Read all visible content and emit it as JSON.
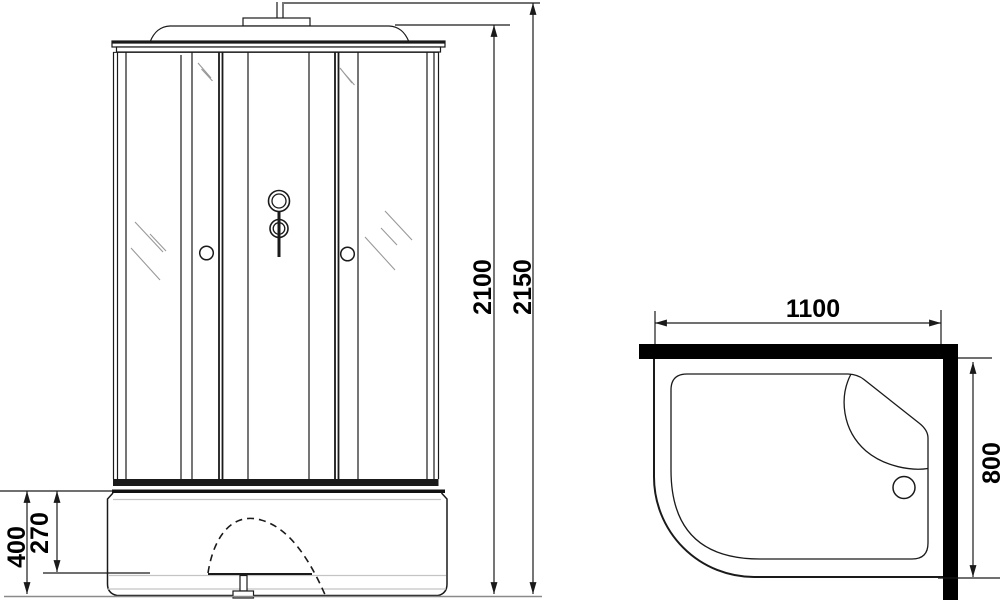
{
  "drawing": {
    "type": "shower-cabin-technical-drawing",
    "dimensions": {
      "front": {
        "overall_height": "2150",
        "cabin_height": "2100",
        "tray_height": "400",
        "tray_step_height": "270"
      },
      "top": {
        "width": "1100",
        "depth": "800"
      }
    },
    "colors": {
      "line": "#1a1a1a",
      "wall_fill": "#000000",
      "hatch": "#999999",
      "light_line": "#c4c4c4",
      "background": "#ffffff"
    }
  }
}
